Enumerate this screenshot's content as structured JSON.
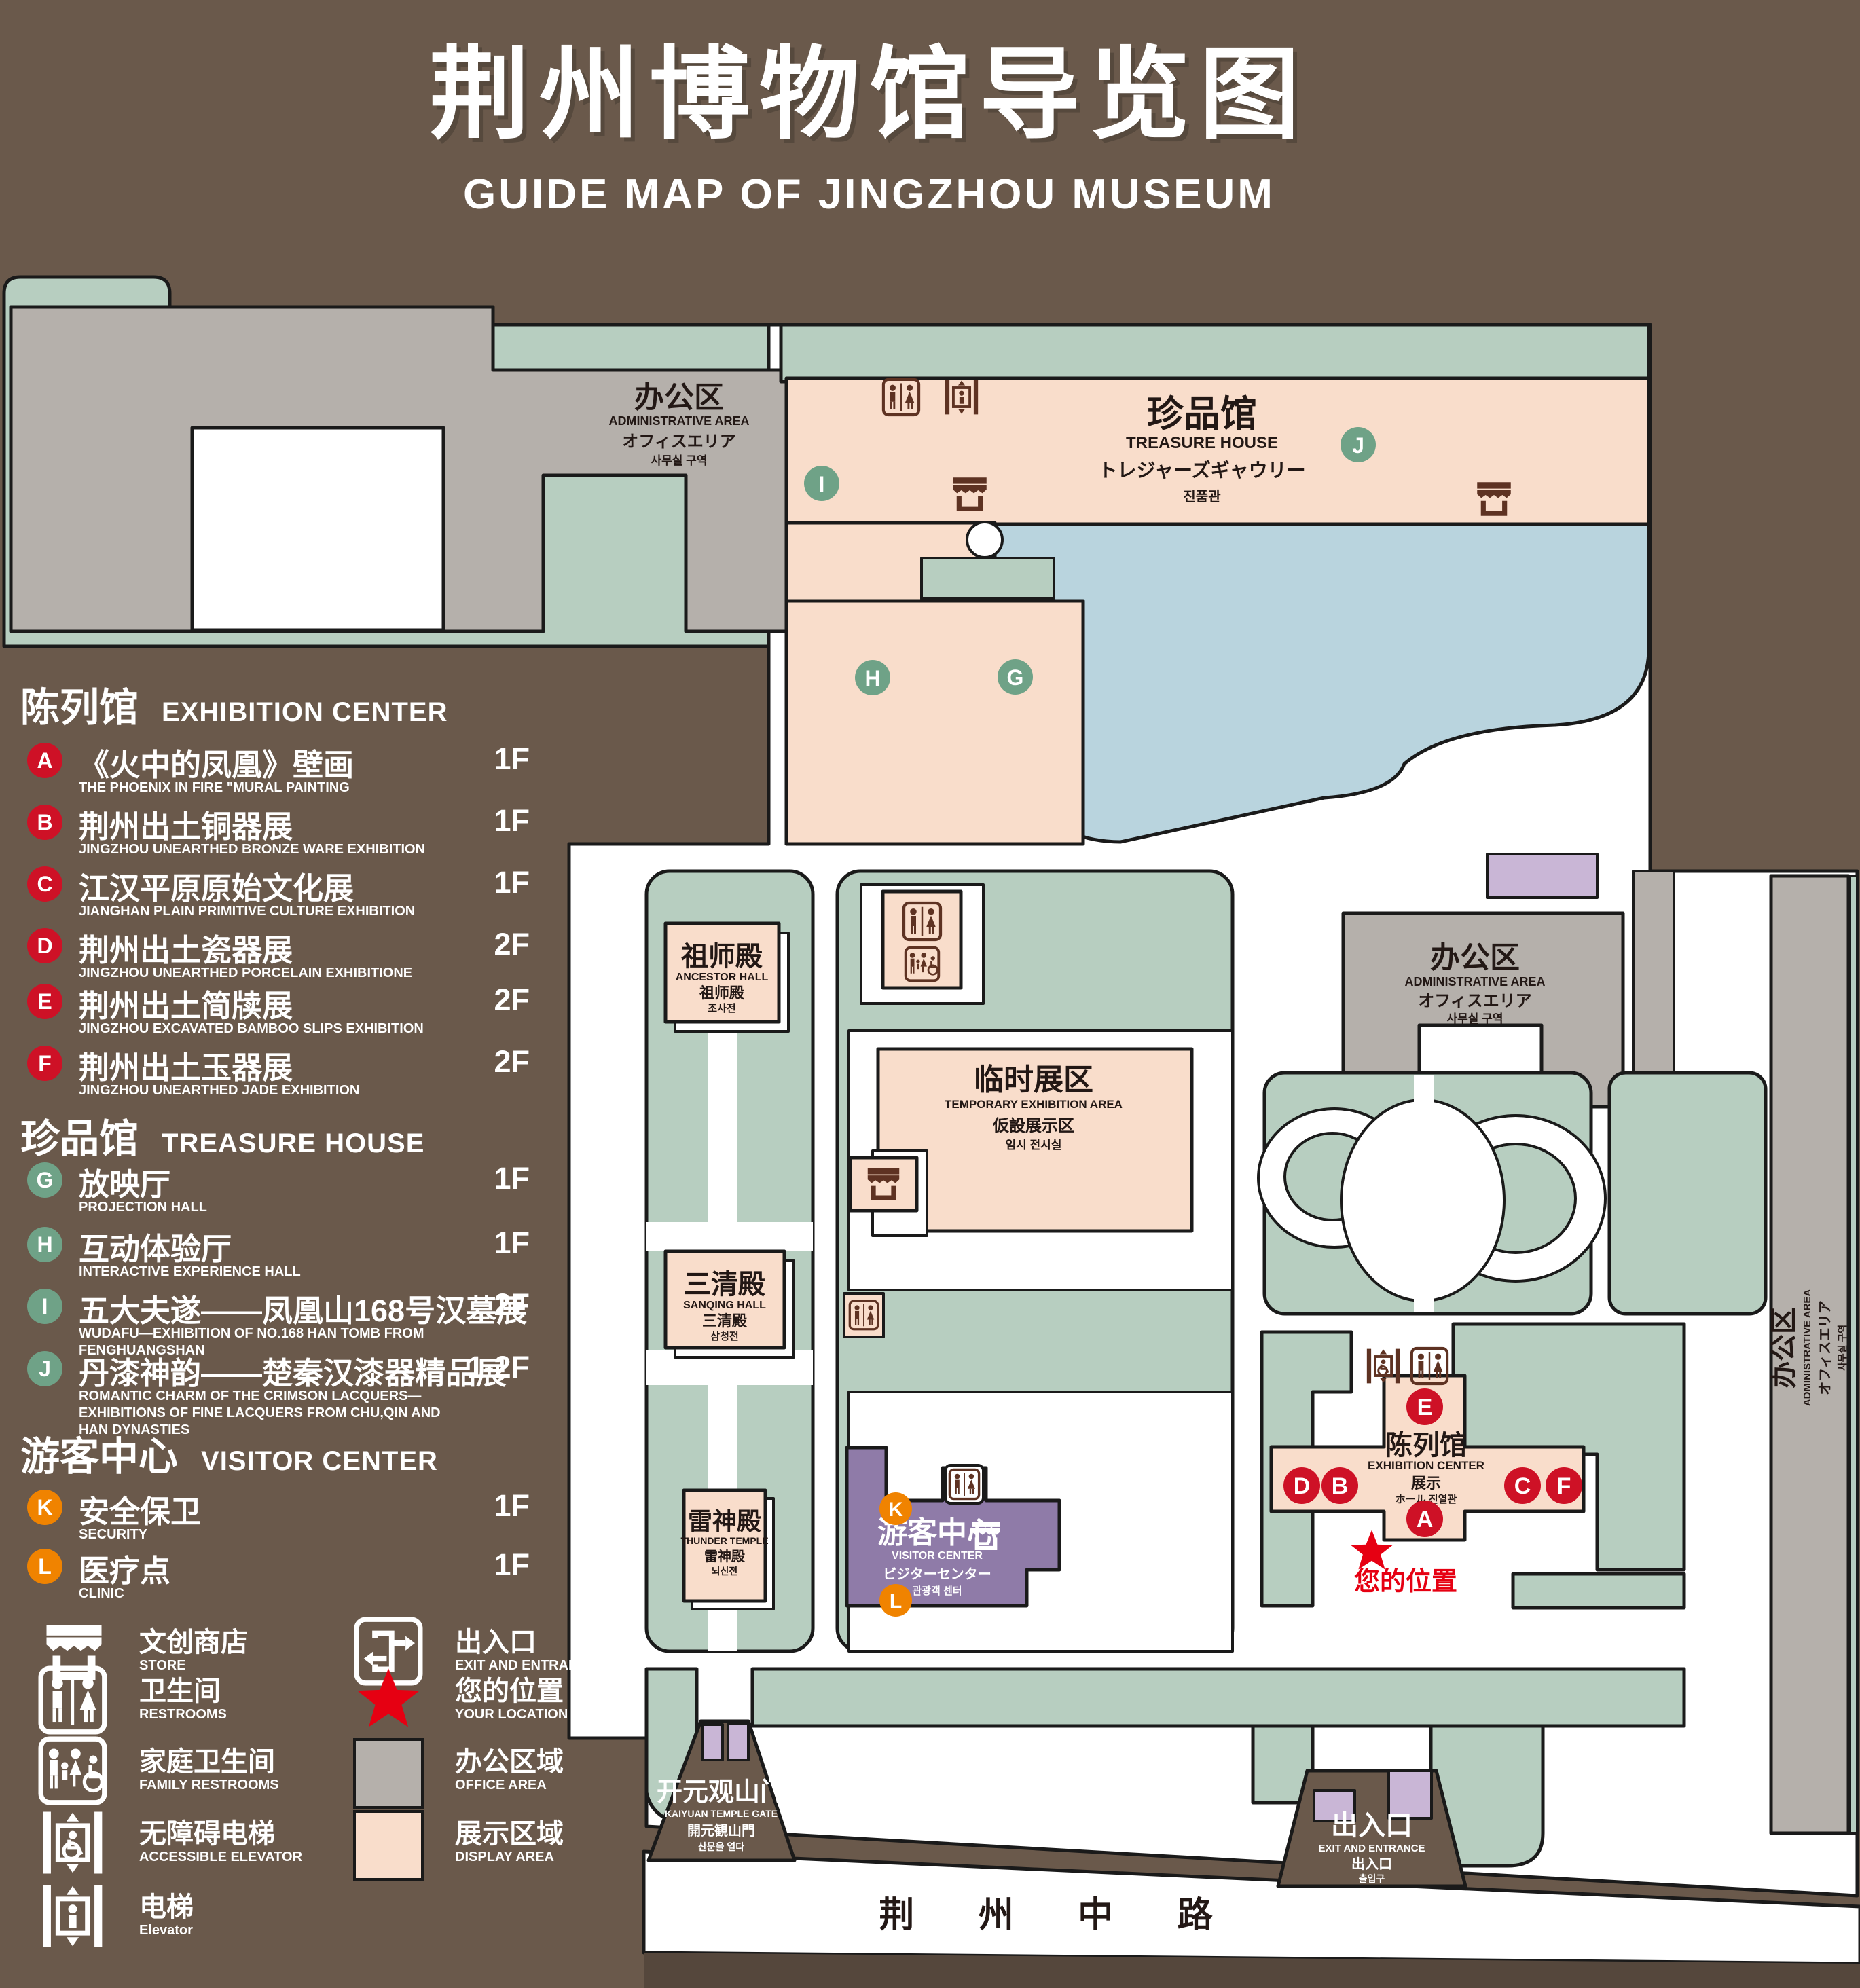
{
  "title": {
    "zh": "荆州博物馆导览图",
    "en": "GUIDE MAP OF JINGZHOU MUSEUM"
  },
  "colors": {
    "background_brown": "#6A594B",
    "green_area": "#B7CEC0",
    "office_gray": "#B5B0AB",
    "display_pink": "#F9DDCB",
    "pond_blue": "#B9D4DE",
    "visitor_purple": "#8F7BA8",
    "gate_purple": "#C9B6D6",
    "badge_red": "#CE1126",
    "badge_green": "#6FA287",
    "badge_orange": "#F08300",
    "icon_brown": "#5E3222",
    "location_red": "#E60012"
  },
  "legend": {
    "sections": [
      {
        "zh": "陈列馆",
        "en": "EXHIBITION CENTER",
        "items": [
          {
            "letter": "A",
            "zh": "《火中的凤凰》壁画",
            "en": "THE PHOENIX IN FIRE \"MURAL PAINTING",
            "floor": "1F"
          },
          {
            "letter": "B",
            "zh": "荆州出土铜器展",
            "en": "JINGZHOU UNEARTHED BRONZE WARE EXHIBITION",
            "floor": "1F"
          },
          {
            "letter": "C",
            "zh": "江汉平原原始文化展",
            "en": "JIANGHAN PLAIN PRIMITIVE CULTURE EXHIBITION",
            "floor": "1F"
          },
          {
            "letter": "D",
            "zh": "荆州出土瓷器展",
            "en": "JINGZHOU UNEARTHED PORCELAIN EXHIBITIONE",
            "floor": "2F"
          },
          {
            "letter": "E",
            "zh": "荆州出土简牍展",
            "en": "JINGZHOU EXCAVATED BAMBOO SLIPS EXHIBITION",
            "floor": "2F"
          },
          {
            "letter": "F",
            "zh": "荆州出土玉器展",
            "en": "JINGZHOU UNEARTHED JADE EXHIBITION",
            "floor": "2F"
          }
        ]
      },
      {
        "zh": "珍品馆",
        "en": "TREASURE HOUSE",
        "items": [
          {
            "letter": "G",
            "zh": "放映厅",
            "en": "PROJECTION HALL",
            "floor": "1F"
          },
          {
            "letter": "H",
            "zh": "互动体验厅",
            "en": "INTERACTIVE EXPERIENCE HALL",
            "floor": "1F"
          },
          {
            "letter": "I",
            "zh": "五大夫遂——凤凰山168号汉墓展",
            "en": "WUDAFU—EXHIBITION OF NO.168 HAN TOMB FROM FENGHUANGSHAN",
            "floor": "2F"
          },
          {
            "letter": "J",
            "zh": "丹漆神韵——楚秦汉漆器精品展",
            "en": "ROMANTIC CHARM OF THE CRIMSON LACQUERS—EXHIBITIONS OF FINE LACQUERS FROM CHU,QIN AND HAN DYNASTIES",
            "floor": "1-2F"
          }
        ]
      },
      {
        "zh": "游客中心",
        "en": "VISITOR CENTER",
        "items": [
          {
            "letter": "K",
            "zh": "安全保卫",
            "en": "SECURITY",
            "floor": "1F"
          },
          {
            "letter": "L",
            "zh": "医疗点",
            "en": "CLINIC",
            "floor": "1F"
          }
        ]
      }
    ],
    "symbols": [
      {
        "zh": "文创商店",
        "en": "STORE"
      },
      {
        "zh": "卫生间",
        "en": "RESTROOMS"
      },
      {
        "zh": "家庭卫生间",
        "en": "FAMILY RESTROOMS"
      },
      {
        "zh": "无障碍电梯",
        "en": "ACCESSIBLE ELEVATOR"
      },
      {
        "zh": "电梯",
        "en": "Elevator"
      },
      {
        "zh": "出入口",
        "en": "EXIT AND ENTRANCE"
      },
      {
        "zh": "您的位置",
        "en": "YOUR LOCATION"
      },
      {
        "zh": "办公区域",
        "en": "OFFICE AREA"
      },
      {
        "zh": "展示区域",
        "en": "DISPLAY AREA"
      }
    ]
  },
  "map": {
    "buildings": {
      "admin": {
        "zh": "办公区",
        "en": "ADMINISTRATIVE AREA",
        "ja": "オフィスエリア",
        "ko": "사무실 구역"
      },
      "treasure": {
        "zh": "珍品馆",
        "en": "TREASURE HOUSE",
        "ja": "トレジャーズギャウリー",
        "ko": "진품관"
      },
      "ancestor": {
        "zh": "祖师殿",
        "en": "ANCESTOR HALL",
        "ja": "祖师殿",
        "ko": "조사전"
      },
      "temporary": {
        "zh": "临时展区",
        "en": "TEMPORARY EXHIBITION AREA",
        "ja": "仮設展示区",
        "ko": "임시 전시실"
      },
      "sanqing": {
        "zh": "三清殿",
        "en": "SANQING HALL",
        "ja": "三清殿",
        "ko": "삼청전"
      },
      "thunder": {
        "zh": "雷神殿",
        "en": "THUNDER TEMPLE",
        "ja": "雷神殿",
        "ko": "뇌신전"
      },
      "visitor": {
        "zh": "游客中心",
        "en": "VISITOR CENTER",
        "ja": "ビジターセンター",
        "ko": "관광객 센터"
      },
      "exhibition": {
        "zh": "陈列馆",
        "en": "EXHIBITION CENTER",
        "ja": "展示",
        "ko": "ホール 진열관"
      },
      "gate": {
        "zh": "开元观山门",
        "en": "KAIYUAN TEMPLE GATE",
        "ja": "開元観山門",
        "ko": "산문을 열다"
      },
      "exit": {
        "zh": "出入口",
        "en": "EXIT AND ENTRANCE",
        "ja": "出入口",
        "ko": "출입구"
      }
    },
    "road": "荆 州 中 路",
    "your_location": "您的位置",
    "markers": [
      "A",
      "B",
      "C",
      "D",
      "E",
      "F",
      "G",
      "H",
      "I",
      "J",
      "K",
      "L"
    ]
  }
}
